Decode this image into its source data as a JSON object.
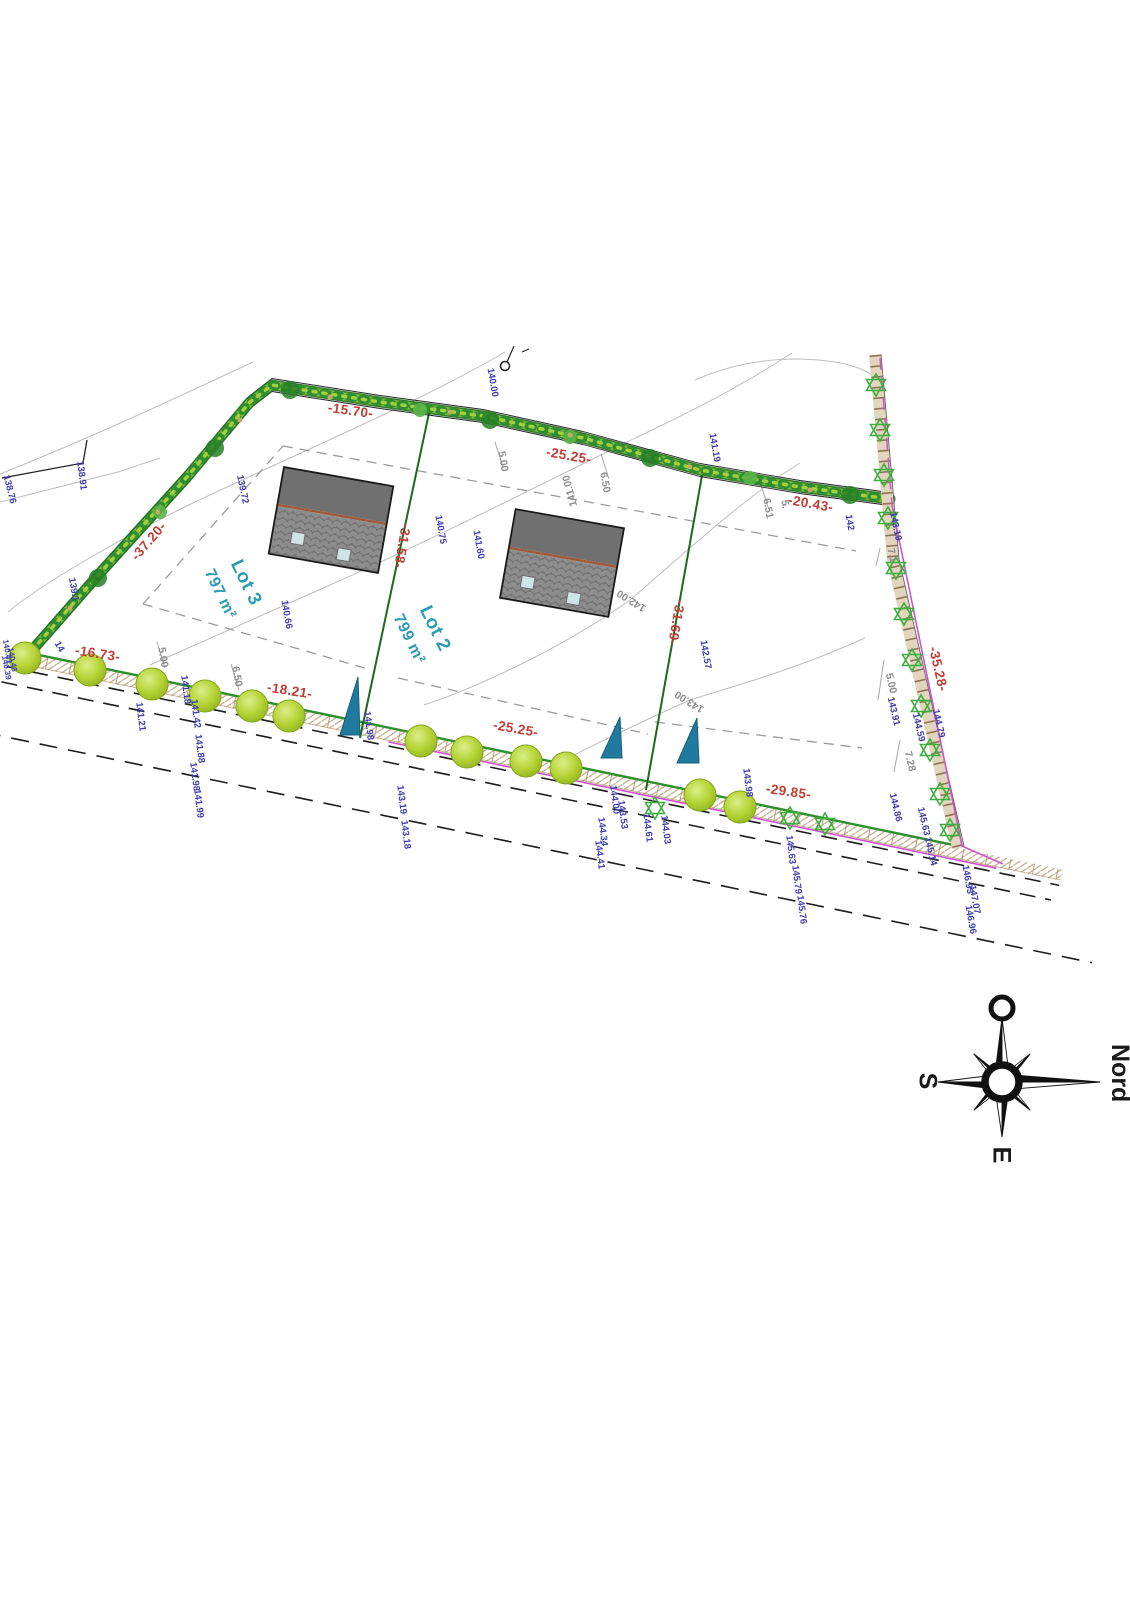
{
  "drawing_type": "plan de division / site survey plan",
  "compass": {
    "north": "Nord",
    "west": "O",
    "south": "S",
    "east": "E"
  },
  "lots": [
    {
      "name": "Lot 3",
      "area": "797 m²"
    },
    {
      "name": "Lot 2",
      "area": "799 m²"
    }
  ],
  "palette": {
    "dimension_red": "#c23b35",
    "elevation_blue": "#3c3cae",
    "offset_gray": "#8d8d8d",
    "lot_teal": "#2b9cb0",
    "hedge_green": "#2f8f2f",
    "tree_green": "#b5d334",
    "boundary_green": "#1b6b1b",
    "road_magenta": "#cc55cc",
    "triangle_teal": "#1f7a9e",
    "fence_star_green": "#3fae3f",
    "hatch_tan": "#b59b7a"
  },
  "labels": {
    "red": [
      {
        "t": "-15.70-",
        "x": 350,
        "y": 415,
        "r": 8
      },
      {
        "t": "-25.25-",
        "x": 568,
        "y": 460,
        "r": 10
      },
      {
        "t": "-20.43-",
        "x": 810,
        "y": 508,
        "r": 10
      },
      {
        "t": "-37.20-",
        "x": 152,
        "y": 544,
        "r": -49
      },
      {
        "t": "-31.58-",
        "x": 398,
        "y": 545,
        "r": 100
      },
      {
        "t": "-31.69-",
        "x": 672,
        "y": 622,
        "r": 100
      },
      {
        "t": "-35.28-",
        "x": 934,
        "y": 670,
        "r": 77
      },
      {
        "t": "-16.73-",
        "x": 97,
        "y": 658,
        "r": 9
      },
      {
        "t": "-18.21-",
        "x": 289,
        "y": 695,
        "r": 9
      },
      {
        "t": "-25.25-",
        "x": 515,
        "y": 733,
        "r": 10
      },
      {
        "t": "-29.85-",
        "x": 788,
        "y": 796,
        "r": 8
      }
    ],
    "gray": [
      {
        "t": "5.00",
        "x": 500,
        "y": 462,
        "r": 80
      },
      {
        "t": "6.50",
        "x": 602,
        "y": 483,
        "r": 80
      },
      {
        "t": "141.00",
        "x": 573,
        "y": 490,
        "r": 255
      },
      {
        "t": "6.51",
        "x": 765,
        "y": 509,
        "r": 80
      },
      {
        "t": "5.",
        "x": 782,
        "y": 505,
        "r": 80
      },
      {
        "t": "142.00",
        "x": 633,
        "y": 598,
        "r": 212
      },
      {
        "t": "143.00",
        "x": 691,
        "y": 699,
        "r": 212
      },
      {
        "t": "5.00",
        "x": 160,
        "y": 658,
        "r": 80
      },
      {
        "t": "6.50",
        "x": 234,
        "y": 677,
        "r": 80
      },
      {
        "t": "7.1",
        "x": 889,
        "y": 556,
        "r": 78
      },
      {
        "t": "5.00",
        "x": 888,
        "y": 684,
        "r": 77
      },
      {
        "t": "7.28",
        "x": 907,
        "y": 762,
        "r": 77
      }
    ],
    "blue": [
      {
        "t": "138.76",
        "x": 7,
        "y": 490,
        "r": 76
      },
      {
        "t": "138.91",
        "x": 79,
        "y": 476,
        "r": 83
      },
      {
        "t": "139.1",
        "x": 71,
        "y": 590,
        "r": 80
      },
      {
        "t": "14",
        "x": 57,
        "y": 648,
        "r": 60
      },
      {
        "t": "139.72",
        "x": 240,
        "y": 490,
        "r": 78
      },
      {
        "t": "140.00",
        "x": 490,
        "y": 383,
        "r": 80
      },
      {
        "t": "140.66",
        "x": 284,
        "y": 615,
        "r": 80
      },
      {
        "t": "140.75",
        "x": 438,
        "y": 530,
        "r": 80
      },
      {
        "t": "141.60",
        "x": 476,
        "y": 545,
        "r": 80
      },
      {
        "t": "141.19",
        "x": 712,
        "y": 448,
        "r": 80
      },
      {
        "t": "142",
        "x": 847,
        "y": 523,
        "r": 80
      },
      {
        "t": "143.19",
        "x": 893,
        "y": 527,
        "r": 78
      },
      {
        "t": "142.57",
        "x": 703,
        "y": 655,
        "r": 80
      },
      {
        "t": "140.41",
        "x": 5,
        "y": 652,
        "r": 80,
        "s": 8
      },
      {
        "t": "140.46",
        "x": 10,
        "y": 660,
        "r": 80,
        "s": 8
      },
      {
        "t": "140.39",
        "x": 4,
        "y": 668,
        "r": 80,
        "s": 8
      },
      {
        "t": "141.21",
        "x": 138,
        "y": 717,
        "r": 83
      },
      {
        "t": "141.18",
        "x": 183,
        "y": 690,
        "r": 83
      },
      {
        "t": "141.42",
        "x": 193,
        "y": 714,
        "r": 83
      },
      {
        "t": "141.88",
        "x": 197,
        "y": 749,
        "r": 83
      },
      {
        "t": "141.98",
        "x": 192,
        "y": 777,
        "r": 83
      },
      {
        "t": "141.99",
        "x": 196,
        "y": 804,
        "r": 83
      },
      {
        "t": "141.98",
        "x": 366,
        "y": 726,
        "r": 83
      },
      {
        "t": "143.19",
        "x": 399,
        "y": 800,
        "r": 83
      },
      {
        "t": "143.18",
        "x": 403,
        "y": 835,
        "r": 83
      },
      {
        "t": "144.00",
        "x": 612,
        "y": 800,
        "r": 83
      },
      {
        "t": "143.53",
        "x": 620,
        "y": 815,
        "r": 83
      },
      {
        "t": "144.34",
        "x": 600,
        "y": 832,
        "r": 83
      },
      {
        "t": "144.41",
        "x": 597,
        "y": 855,
        "r": 83
      },
      {
        "t": "144.61",
        "x": 645,
        "y": 828,
        "r": 83
      },
      {
        "t": "144.03",
        "x": 663,
        "y": 830,
        "r": 83
      },
      {
        "t": "143.98",
        "x": 745,
        "y": 783,
        "r": 83
      },
      {
        "t": "145.63",
        "x": 788,
        "y": 850,
        "r": 83
      },
      {
        "t": "145.79",
        "x": 794,
        "y": 880,
        "r": 83
      },
      {
        "t": "145.76",
        "x": 799,
        "y": 910,
        "r": 83
      },
      {
        "t": "143.91",
        "x": 891,
        "y": 712,
        "r": 77
      },
      {
        "t": "144.59",
        "x": 916,
        "y": 728,
        "r": 77
      },
      {
        "t": "144.79",
        "x": 936,
        "y": 724,
        "r": 77
      },
      {
        "t": "144.86",
        "x": 893,
        "y": 808,
        "r": 77
      },
      {
        "t": "145.63",
        "x": 921,
        "y": 822,
        "r": 77
      },
      {
        "t": "145.14",
        "x": 928,
        "y": 852,
        "r": 77
      },
      {
        "t": "146.93",
        "x": 965,
        "y": 880,
        "r": 80
      },
      {
        "t": "147.07",
        "x": 972,
        "y": 900,
        "r": 80
      },
      {
        "t": "146.96",
        "x": 968,
        "y": 920,
        "r": 80
      }
    ]
  }
}
